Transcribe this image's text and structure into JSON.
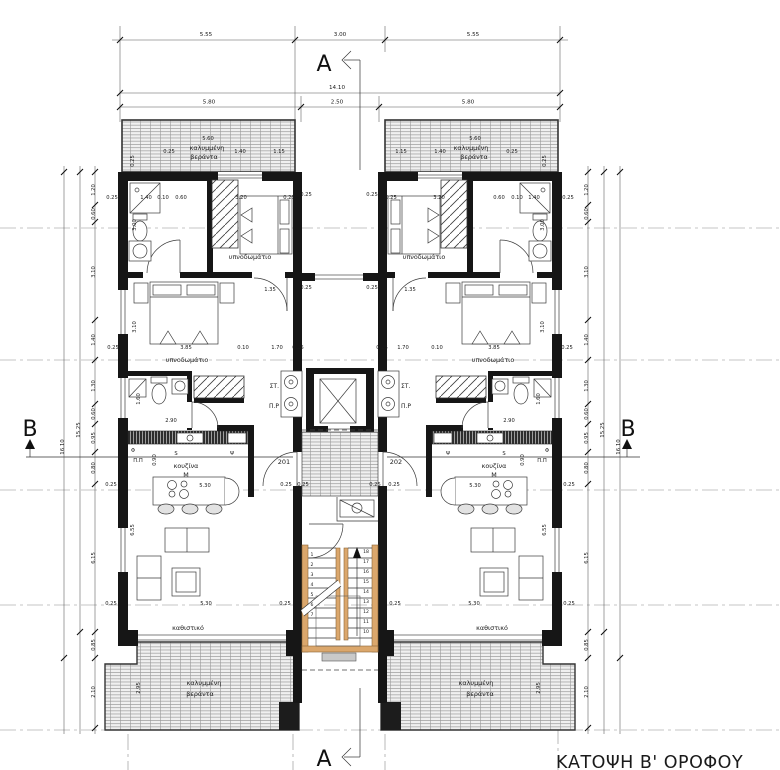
{
  "title": "ΚΑΤΟΨΗ Β' ΟΡΟΦΟΥ",
  "section_markers": {
    "a": "A",
    "b": "B"
  },
  "unit_numbers": {
    "left": "201",
    "right": "202"
  },
  "shaft_labels": {
    "st": "ΣΤ.",
    "pr": "Π.Ρ"
  },
  "room_labels": {
    "bedroom": "υπνοδωμάτιο",
    "kitchen": "κουζίνα",
    "kitchen_sub": "Μ",
    "living": "καθιστικό",
    "veranda_line1": "καλυμμένη",
    "veranda_line2": "βεράντα"
  },
  "top_dimensions": {
    "row1": [
      {
        "v": "5.55",
        "x": 206
      },
      {
        "v": "3.00",
        "x": 340
      },
      {
        "v": "5.55",
        "x": 473
      }
    ],
    "total": {
      "v": "14.10",
      "x": 337
    },
    "row2": [
      {
        "v": "5.80",
        "x": 209
      },
      {
        "v": "2.50",
        "x": 337
      },
      {
        "v": "5.80",
        "x": 468
      }
    ]
  },
  "side_dimensions": {
    "chain": [
      {
        "v": "1.20",
        "y": 190
      },
      {
        "v": "0.60",
        "y": 214
      },
      {
        "v": "3.10",
        "y": 272
      },
      {
        "v": "1.40",
        "y": 340
      },
      {
        "v": "1.30",
        "y": 386
      },
      {
        "v": "0.60",
        "y": 414
      },
      {
        "v": "0.95",
        "y": 438
      },
      {
        "v": "0.80",
        "y": 468
      },
      {
        "v": "6.15",
        "y": 558
      },
      {
        "v": "0.85",
        "y": 645
      },
      {
        "v": "2.10",
        "y": 692
      }
    ],
    "subtotal": "15.25",
    "total": "16.10",
    "left_x": 95,
    "right_x": 588
  },
  "stairs": {
    "left_numbers": [
      "1",
      "2",
      "3",
      "4",
      "5",
      "6",
      "7"
    ],
    "right_numbers": [
      "18",
      "17",
      "16",
      "15",
      "14",
      "13",
      "12",
      "11",
      "10"
    ]
  },
  "room_label_positions": [
    {
      "key": "bedroom",
      "x": 250,
      "y": 259
    },
    {
      "key": "bedroom",
      "x": 424,
      "y": 259
    },
    {
      "key": "bedroom",
      "x": 187,
      "y": 362
    },
    {
      "key": "bedroom",
      "x": 493,
      "y": 362
    },
    {
      "key": "kitchen",
      "x": 186,
      "y": 468
    },
    {
      "key": "kitchen",
      "x": 494,
      "y": 468
    },
    {
      "key": "kitchen_sub",
      "x": 186,
      "y": 477
    },
    {
      "key": "kitchen_sub",
      "x": 494,
      "y": 477
    },
    {
      "key": "living",
      "x": 188,
      "y": 630
    },
    {
      "key": "living",
      "x": 492,
      "y": 630
    },
    {
      "key": "veranda_line1",
      "x": 207,
      "y": 150
    },
    {
      "key": "veranda_line2",
      "x": 204,
      "y": 159
    },
    {
      "key": "veranda_line1",
      "x": 471,
      "y": 150
    },
    {
      "key": "veranda_line2",
      "x": 474,
      "y": 159
    },
    {
      "key": "veranda_line1",
      "x": 204,
      "y": 685
    },
    {
      "key": "veranda_line2",
      "x": 200,
      "y": 696
    },
    {
      "key": "veranda_line1",
      "x": 476,
      "y": 685
    },
    {
      "key": "veranda_line2",
      "x": 480,
      "y": 696
    }
  ],
  "plan_annotations": [
    {
      "t": "5.60",
      "x": 208,
      "y": 140
    },
    {
      "t": "0.25",
      "x": 169,
      "y": 153
    },
    {
      "t": "1.40",
      "x": 240,
      "y": 153
    },
    {
      "t": "1.15",
      "x": 279,
      "y": 153
    },
    {
      "t": "0.25",
      "x": 134,
      "y": 161,
      "r": -90
    },
    {
      "t": "5.60",
      "x": 475,
      "y": 140
    },
    {
      "t": "1.15",
      "x": 401,
      "y": 153
    },
    {
      "t": "1.40",
      "x": 440,
      "y": 153
    },
    {
      "t": "0.25",
      "x": 512,
      "y": 153
    },
    {
      "t": "0.25",
      "x": 546,
      "y": 161,
      "r": -90
    },
    {
      "t": "0.25",
      "x": 112,
      "y": 199
    },
    {
      "t": "1.40",
      "x": 146,
      "y": 199
    },
    {
      "t": "0.10",
      "x": 163,
      "y": 199
    },
    {
      "t": "0.60",
      "x": 181,
      "y": 199
    },
    {
      "t": "3.20",
      "x": 241,
      "y": 199
    },
    {
      "t": "0.25",
      "x": 289,
      "y": 199
    },
    {
      "t": "0.25",
      "x": 391,
      "y": 199
    },
    {
      "t": "3.20",
      "x": 439,
      "y": 199
    },
    {
      "t": "0.60",
      "x": 499,
      "y": 199
    },
    {
      "t": "0.10",
      "x": 517,
      "y": 199
    },
    {
      "t": "1.40",
      "x": 534,
      "y": 199
    },
    {
      "t": "0.25",
      "x": 568,
      "y": 199
    },
    {
      "t": "0.25",
      "x": 306,
      "y": 196
    },
    {
      "t": "0.25",
      "x": 372,
      "y": 196
    },
    {
      "t": "0.25",
      "x": 306,
      "y": 289
    },
    {
      "t": "0.25",
      "x": 372,
      "y": 289
    },
    {
      "t": "0.25",
      "x": 113,
      "y": 349
    },
    {
      "t": "3.85",
      "x": 186,
      "y": 349
    },
    {
      "t": "0.10",
      "x": 243,
      "y": 349
    },
    {
      "t": "1.70",
      "x": 277,
      "y": 349
    },
    {
      "t": "0.25",
      "x": 298,
      "y": 349
    },
    {
      "t": "0.25",
      "x": 382,
      "y": 349
    },
    {
      "t": "1.70",
      "x": 403,
      "y": 349
    },
    {
      "t": "0.10",
      "x": 437,
      "y": 349
    },
    {
      "t": "3.85",
      "x": 494,
      "y": 349
    },
    {
      "t": "0.25",
      "x": 567,
      "y": 349
    },
    {
      "t": "1.35",
      "x": 270,
      "y": 291
    },
    {
      "t": "1.35",
      "x": 410,
      "y": 291
    },
    {
      "t": "2.90",
      "x": 171,
      "y": 422
    },
    {
      "t": "2.90",
      "x": 509,
      "y": 422
    },
    {
      "t": "3.00",
      "x": 136,
      "y": 225,
      "r": -90
    },
    {
      "t": "3.10",
      "x": 136,
      "y": 327,
      "r": -90
    },
    {
      "t": "1.60",
      "x": 140,
      "y": 399,
      "r": -90
    },
    {
      "t": "0.90",
      "x": 156,
      "y": 460,
      "r": -90
    },
    {
      "t": "6.55",
      "x": 134,
      "y": 530,
      "r": -90
    },
    {
      "t": "2.95",
      "x": 140,
      "y": 688,
      "r": -90
    },
    {
      "t": "3.00",
      "x": 544,
      "y": 225,
      "r": -90
    },
    {
      "t": "3.10",
      "x": 544,
      "y": 327,
      "r": -90
    },
    {
      "t": "1.60",
      "x": 540,
      "y": 399,
      "r": -90
    },
    {
      "t": "0.90",
      "x": 524,
      "y": 460,
      "r": -90
    },
    {
      "t": "6.55",
      "x": 546,
      "y": 530,
      "r": -90
    },
    {
      "t": "2.95",
      "x": 540,
      "y": 688,
      "r": -90
    },
    {
      "t": "0.25",
      "x": 303,
      "y": 486
    },
    {
      "t": "0.25",
      "x": 375,
      "y": 486
    },
    {
      "t": "0.25",
      "x": 111,
      "y": 486
    },
    {
      "t": "5.30",
      "x": 205,
      "y": 487
    },
    {
      "t": "0.25",
      "x": 286,
      "y": 486
    },
    {
      "t": "0.25",
      "x": 394,
      "y": 486
    },
    {
      "t": "5.30",
      "x": 475,
      "y": 487
    },
    {
      "t": "0.25",
      "x": 569,
      "y": 486
    },
    {
      "t": "0.25",
      "x": 111,
      "y": 605
    },
    {
      "t": "5.30",
      "x": 206,
      "y": 605
    },
    {
      "t": "0.25",
      "x": 285,
      "y": 605
    },
    {
      "t": "0.25",
      "x": 395,
      "y": 605
    },
    {
      "t": "5.30",
      "x": 474,
      "y": 605
    },
    {
      "t": "0.25",
      "x": 569,
      "y": 605
    },
    {
      "t": "Φ",
      "x": 133,
      "y": 452
    },
    {
      "t": "Π.Π",
      "x": 138,
      "y": 462
    },
    {
      "t": "S",
      "x": 176,
      "y": 455
    },
    {
      "t": "Ψ",
      "x": 232,
      "y": 455
    },
    {
      "t": "Ψ",
      "x": 448,
      "y": 455
    },
    {
      "t": "S",
      "x": 504,
      "y": 455
    },
    {
      "t": "Π.Π",
      "x": 542,
      "y": 462
    },
    {
      "t": "Φ",
      "x": 547,
      "y": 452
    }
  ]
}
